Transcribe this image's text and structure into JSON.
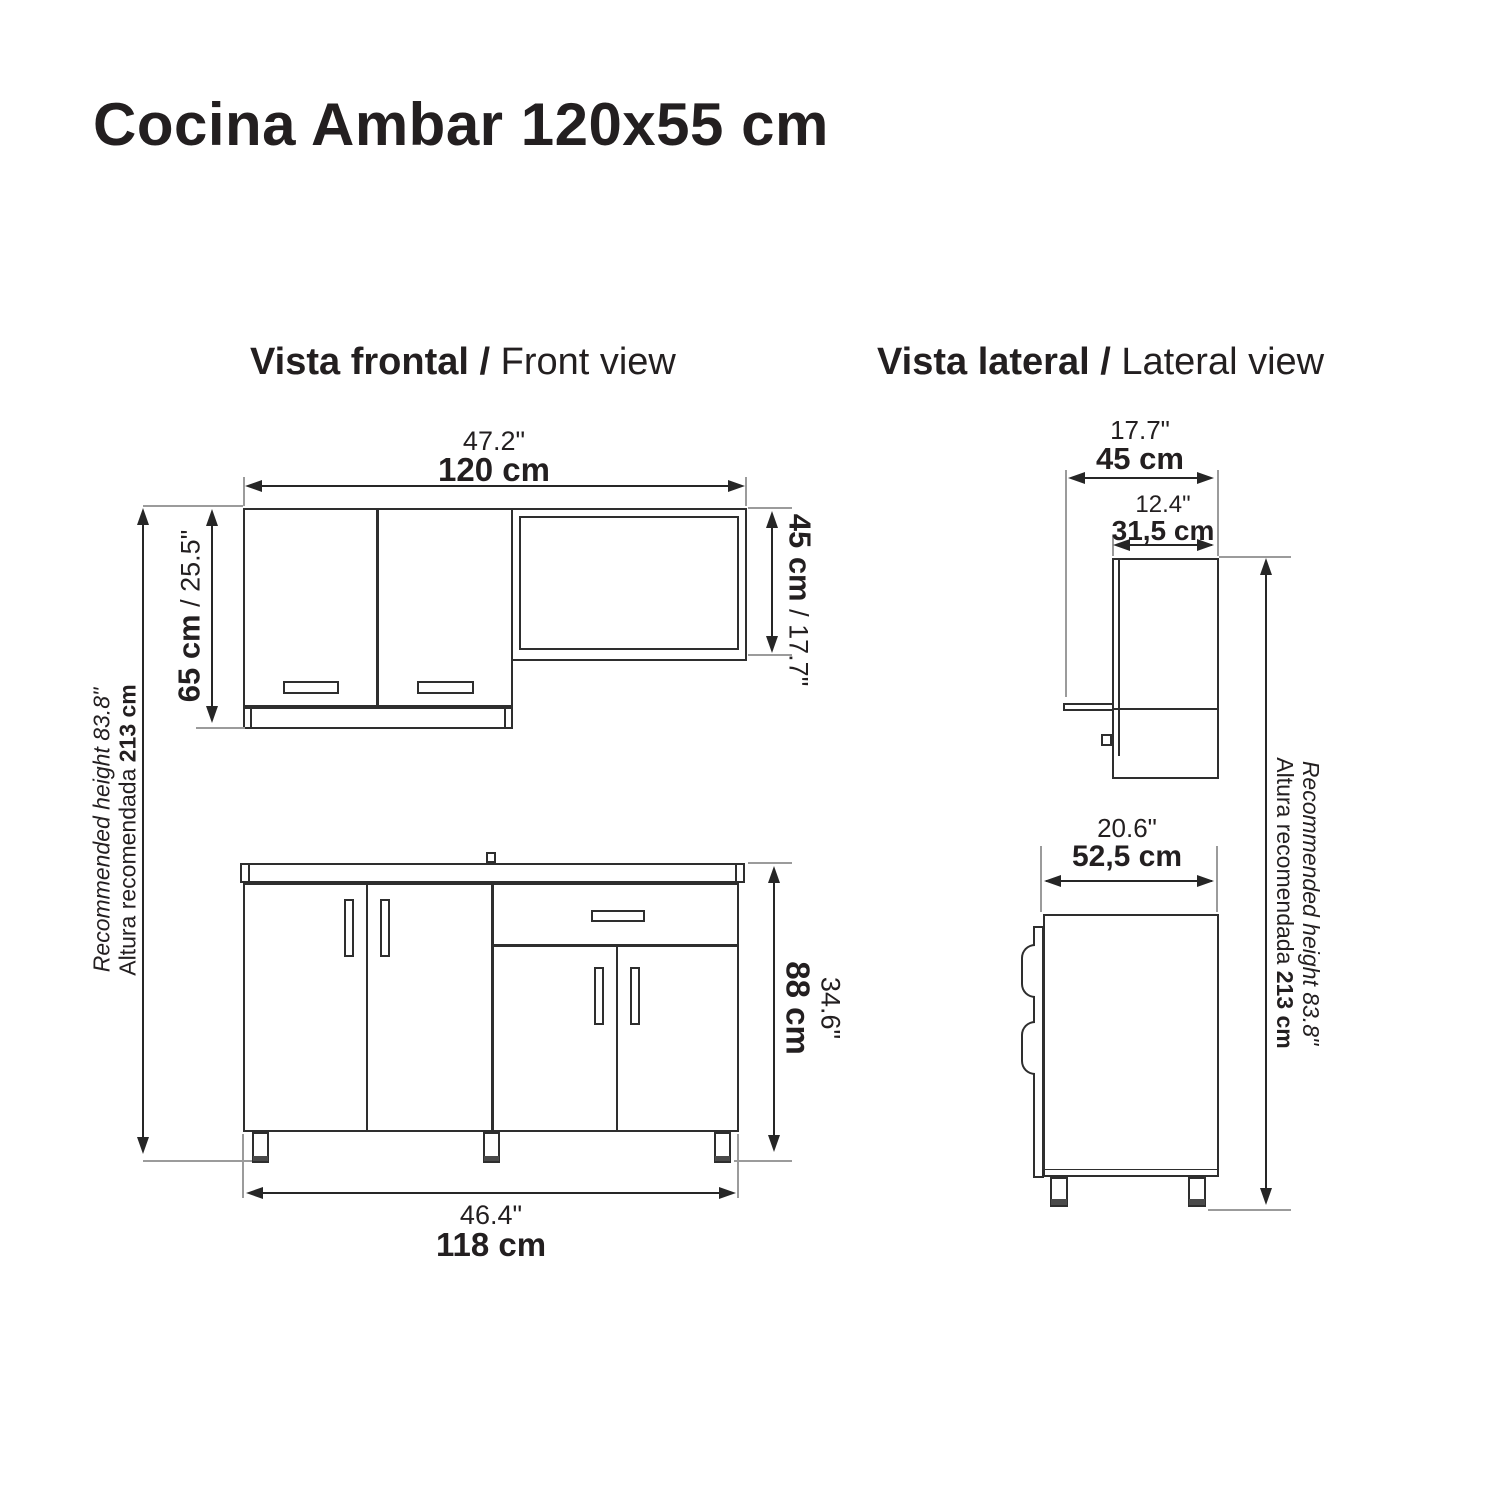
{
  "title": "Cocina Ambar 120x55 cm",
  "sep": " / ",
  "front": {
    "heading": {
      "primary": "Vista frontal",
      "secondary": "Front view"
    },
    "upper_width_in": "47.2\"",
    "upper_width_cm": "120 cm",
    "upper_left_cm": "65 cm",
    "upper_left_in": "25.5\"",
    "upper_right_cm": "45 cm",
    "upper_right_in": "17.7\"",
    "base_width_in": "46.4\"",
    "base_width_cm": "118 cm",
    "base_height_in": "34.6\"",
    "base_height_cm": "88 cm"
  },
  "lateral": {
    "heading": {
      "primary": "Vista lateral",
      "secondary": "Lateral view"
    },
    "upper_depth_in": "17.7\"",
    "upper_depth_cm": "45 cm",
    "cabinet_depth_in": "12.4\"",
    "cabinet_depth_cm": "31,5 cm",
    "base_depth_in": "20.6\"",
    "base_depth_cm": "52,5 cm"
  },
  "recommended": {
    "line1": "Recommended height 83.8\"",
    "line2_text": "Altura recomendada ",
    "line2_value": "213 cm"
  }
}
